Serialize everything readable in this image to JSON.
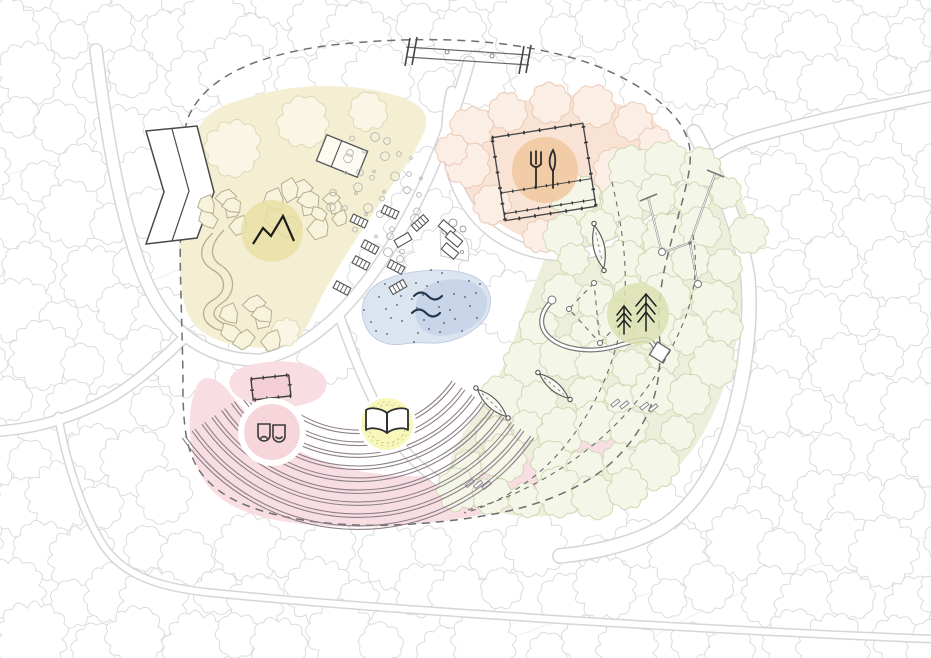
{
  "document": {
    "kind": "park-landscape-masterplan-drawing",
    "background": "#ffffff"
  },
  "palette": {
    "background": "#ffffff",
    "contour_line": "#efefef",
    "tree_line": "#dcdcdc",
    "tree_fill": "#ffffff",
    "road_edge": "#d6d6d6",
    "road_fill": "#ffffff",
    "boundary_dash": "#6f6f6f",
    "structure_dark": "#4a4a4a",
    "structure_mid": "#777777",
    "cable_gray": "#949494",
    "rock_line": "#b7ae8f",
    "rock_fill": "#f8f3dd",
    "planting_dot": "#b5b5b5",
    "ink": "#1d1d1d",
    "yellow_tree_line": "#ded9b4",
    "yellow_tree_fill": "#f9f6e6",
    "orange_tree_line": "#ecc9b6",
    "orange_tree_fill": "#fbeee4",
    "green_tree_line": "#d2d8b4",
    "green_tree_fill": "#f4f6e8"
  },
  "zones": {
    "rock_garden": {
      "name": "rock-and-boulder-garden",
      "fill": "#f4efd3",
      "badge_fill": "#e9dfa4",
      "icon": "mountain-icon"
    },
    "picnic": {
      "name": "picnic-grove",
      "fill": "#f9e3d5",
      "badge_fill": "#f1c9a1",
      "icon": "cutlery-icon"
    },
    "forest": {
      "name": "adventure-forest",
      "fill": "#edefdc",
      "badge_fill": "#dce1b2",
      "icon": "pine-trees-icon"
    },
    "amphitheatre": {
      "name": "amphitheatre-lawn",
      "fill": "#f8dee3",
      "stage_fill": "#f4cfd8",
      "mask_circle_fill": "#f6d6db",
      "seat_line": "#8e8089",
      "icon": "theatre-masks-icon"
    },
    "reading": {
      "name": "reading-circle",
      "fill": "#f8f8bb",
      "ring": "#c6c68d",
      "icon": "open-book-icon"
    },
    "pond": {
      "name": "pond",
      "fill": "#dce4f0",
      "inner_fill": "#c9d6ea",
      "water_ink": "#22384e",
      "icon": "water-waves-icon"
    }
  },
  "features": [
    "footbridge-structure",
    "bent-building-structure",
    "pergola-structure",
    "sandpit-structure",
    "lounger-benches",
    "boulder-clusters",
    "winding-trail",
    "balance-snake-path",
    "rope-course",
    "hammock-leaves",
    "log-steps",
    "site-boundary-dashed",
    "forest-trails-dashed",
    "background-forest"
  ]
}
